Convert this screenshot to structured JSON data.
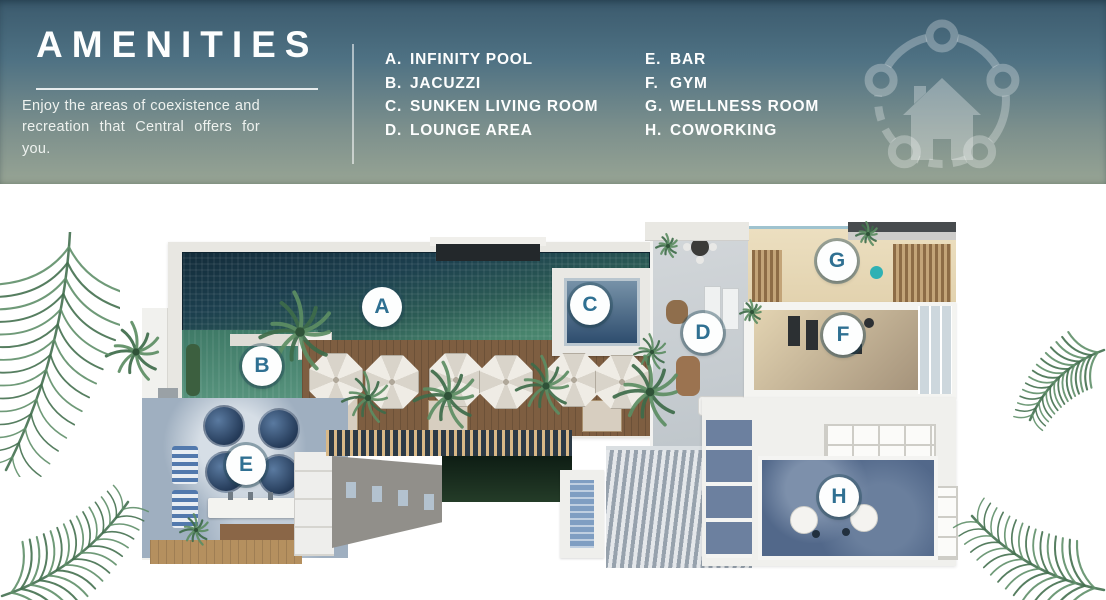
{
  "header": {
    "title": "AMENITIES",
    "description": "Enjoy the areas of coexistence and recreation that Central offers for you.",
    "background_top": "#3b5a6d",
    "background_bottom": "#97a494",
    "text_color": "#fdfefe"
  },
  "legend": {
    "columns": [
      {
        "items": [
          {
            "key": "A.",
            "label": "INFINITY POOL"
          },
          {
            "key": "B.",
            "label": "JACUZZI"
          },
          {
            "key": "C.",
            "label": "SUNKEN LIVING ROOM"
          },
          {
            "key": "D.",
            "label": "LOUNGE AREA"
          }
        ]
      },
      {
        "items": [
          {
            "key": "E.",
            "label": "BAR"
          },
          {
            "key": "F.",
            "label": "GYM"
          },
          {
            "key": "G.",
            "label": "WELLNESS ROOM"
          },
          {
            "key": "H.",
            "label": "COWORKING"
          }
        ]
      }
    ]
  },
  "icons": {
    "house_network_icon": "house surrounded by five connected circles (community network watermark)",
    "palm_tree_icon": "top-view palm tree",
    "palm_frond_icon": "watercolor palm frond corner decoration"
  },
  "floor_plan": {
    "marker_letter_color": "#2f7092",
    "pool_color": "#52907a",
    "markers": [
      {
        "letter": "A",
        "label": "INFINITY POOL",
        "x": 382,
        "y": 307
      },
      {
        "letter": "B",
        "label": "JACUZZI",
        "x": 262,
        "y": 366
      },
      {
        "letter": "C",
        "label": "SUNKEN LIVING ROOM",
        "x": 590,
        "y": 305
      },
      {
        "letter": "D",
        "label": "LOUNGE AREA",
        "x": 703,
        "y": 333
      },
      {
        "letter": "E",
        "label": "BAR",
        "x": 246,
        "y": 465
      },
      {
        "letter": "F",
        "label": "GYM",
        "x": 843,
        "y": 335
      },
      {
        "letter": "G",
        "label": "WELLNESS ROOM",
        "x": 837,
        "y": 261
      },
      {
        "letter": "H",
        "label": "COWORKING",
        "x": 839,
        "y": 497
      }
    ]
  }
}
